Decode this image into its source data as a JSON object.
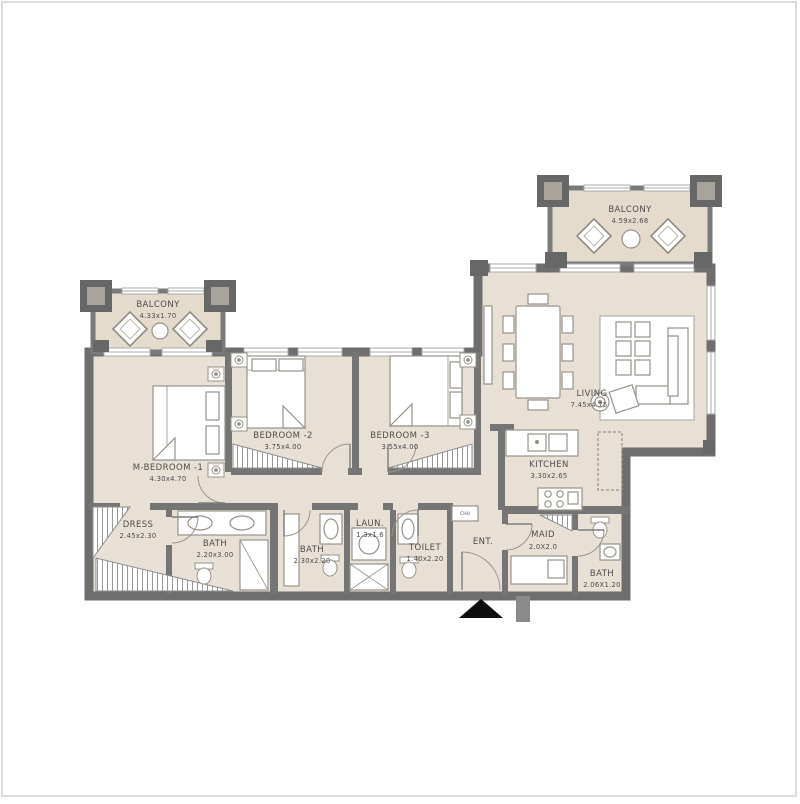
{
  "palette": {
    "wall": "#6e6e6e",
    "wall_inner": "#7d7d7d",
    "floor": "#e9e0d5",
    "balcony_floor": "#e5dbcd",
    "furniture_stroke": "#979289",
    "text": "#4d4d4d",
    "entry_marker": "#0d0d0d"
  },
  "rooms": {
    "balconyTop": {
      "label": "BALCONY",
      "dims": "4.59x2.68"
    },
    "balconyLeft": {
      "label": "BALCONY",
      "dims": "4.33x1.70"
    },
    "living": {
      "label": "LIVING",
      "dims": "7.45x4.75"
    },
    "kitchen": {
      "label": "KITCHEN",
      "dims": "3.30x2.65"
    },
    "mBedroom": {
      "label": "M-BEDROOM -1",
      "dims": "4.30x4.70"
    },
    "bedroom2": {
      "label": "BEDROOM -2",
      "dims": "3.75x4.00"
    },
    "bedroom3": {
      "label": "BEDROOM -3",
      "dims": "3.55x4.00"
    },
    "dress": {
      "label": "DRESS",
      "dims": "2.45x2.30"
    },
    "bathMaster": {
      "label": "BATH",
      "dims": "2.20x3.00"
    },
    "bath2": {
      "label": "BATH",
      "dims": "2.30x2.20"
    },
    "laundry": {
      "label": "LAUN.",
      "dims": "1.3x1.6"
    },
    "toilet": {
      "label": "TOILET",
      "dims": "1.40x2.20"
    },
    "ent": {
      "label": "ENT."
    },
    "maid": {
      "label": "MAID",
      "dims": "2.0X2.0"
    },
    "bathMaid": {
      "label": "BATH",
      "dims": "2.06X1.20"
    },
    "chute": {
      "label": "CHU"
    }
  }
}
